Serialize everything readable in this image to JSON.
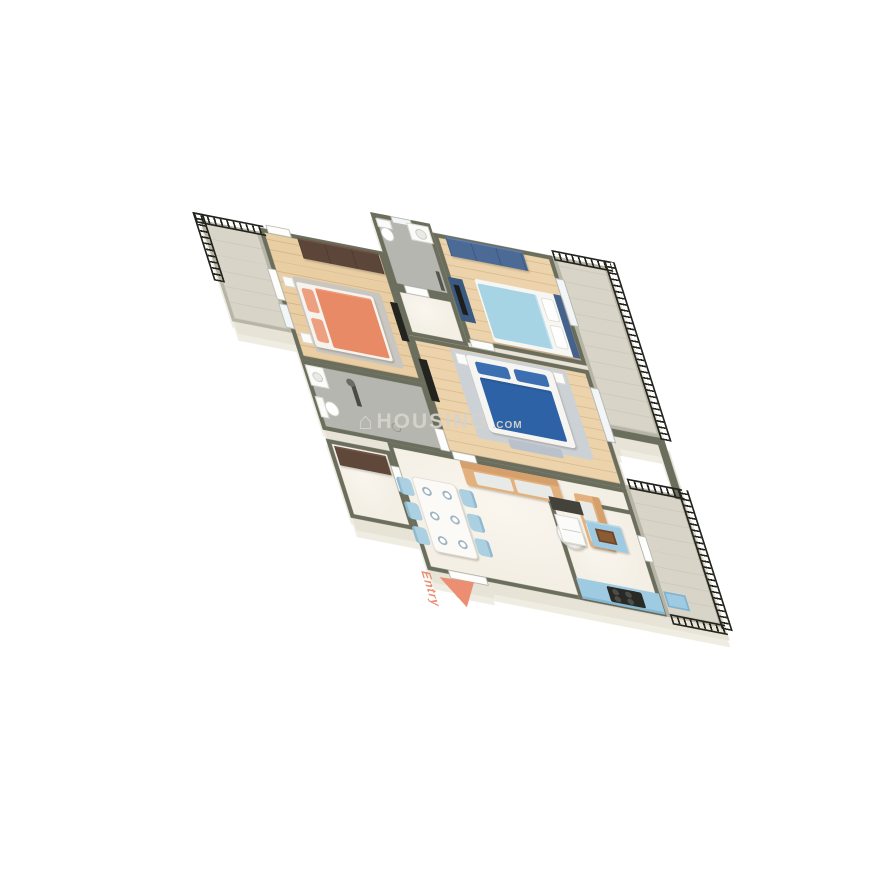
{
  "watermark": {
    "icon": "house-icon",
    "brand": "HOUSING",
    "suffix": ".COM"
  },
  "entry": {
    "label": "Entry"
  },
  "palette": {
    "wall": "#6b6e5d",
    "wall_light": "#b7b5a6",
    "wood": "#e9cda3",
    "wood2": "#ecd3ab",
    "tile": "#b6b6b1",
    "marble": "#f4efe5",
    "balcony_floor": "#d8d4c7",
    "railing": "#23231e",
    "bed1": "#e88a66",
    "bed1_pillow": "#eda07f",
    "bed2_blanket": "#a6d4e4",
    "bed2_head": "#44628c",
    "bed_master": "#2d62a6",
    "bed_master_blanket": "#2a5b97",
    "bed_master_pillow": "#3c6fb2",
    "dresser": "#4b6a96",
    "wardrobe": "#5c463a",
    "bench": "#5f483a",
    "sofa": "#e3b17d",
    "sofa_arm": "#d5a06b",
    "cushion": "#e8eae7",
    "chair": "#abd0e2",
    "kitchen_unit": "#9ecbe2",
    "kitchen_edge": "#86b7d4",
    "sink_basin": "#8a5b34",
    "stove": "#292925",
    "rug": "#c9c6c0",
    "rug_master": "#ccd1d5",
    "entry_accent": "#eb8e72",
    "watermark_color": "#d6d3cb"
  },
  "scene": {
    "type": "3d-isometric-floor-plan",
    "rooms": [
      {
        "id": "balcony-1",
        "floor": "balcony"
      },
      {
        "id": "bedroom-1",
        "floor": "wood",
        "furniture": [
          "coral-double-bed",
          "wardrobe",
          "rug",
          "nightstands",
          "tv-panel"
        ]
      },
      {
        "id": "bathroom-1",
        "floor": "tile",
        "furniture": [
          "toilet",
          "vanity",
          "shower"
        ]
      },
      {
        "id": "bedroom-2",
        "floor": "wood",
        "furniture": [
          "light-blue-double-bed",
          "blue-dresser",
          "tv-unit"
        ]
      },
      {
        "id": "balcony-2",
        "floor": "balcony"
      },
      {
        "id": "master-bedroom",
        "floor": "wood",
        "furniture": [
          "dark-blue-double-bed",
          "rug",
          "nightstands",
          "bench",
          "tv-panel"
        ]
      },
      {
        "id": "bathroom-2",
        "floor": "tile",
        "furniture": [
          "washbasin",
          "toilet",
          "shower",
          "drain"
        ]
      },
      {
        "id": "foyer",
        "floor": "marble",
        "furniture": [
          "brown-bench"
        ]
      },
      {
        "id": "living-dining",
        "floor": "marble",
        "furniture": [
          "sofa-long",
          "sofa-short",
          "coffee-table",
          "dining-table",
          "six-blue-chairs",
          "six-plates"
        ]
      },
      {
        "id": "kitchen",
        "floor": "marble",
        "furniture": [
          "dark-counter",
          "fridge",
          "island-with-sink",
          "counter-with-stove"
        ]
      },
      {
        "id": "balcony-3",
        "floor": "balcony",
        "furniture": [
          "utility-basin"
        ]
      }
    ]
  }
}
